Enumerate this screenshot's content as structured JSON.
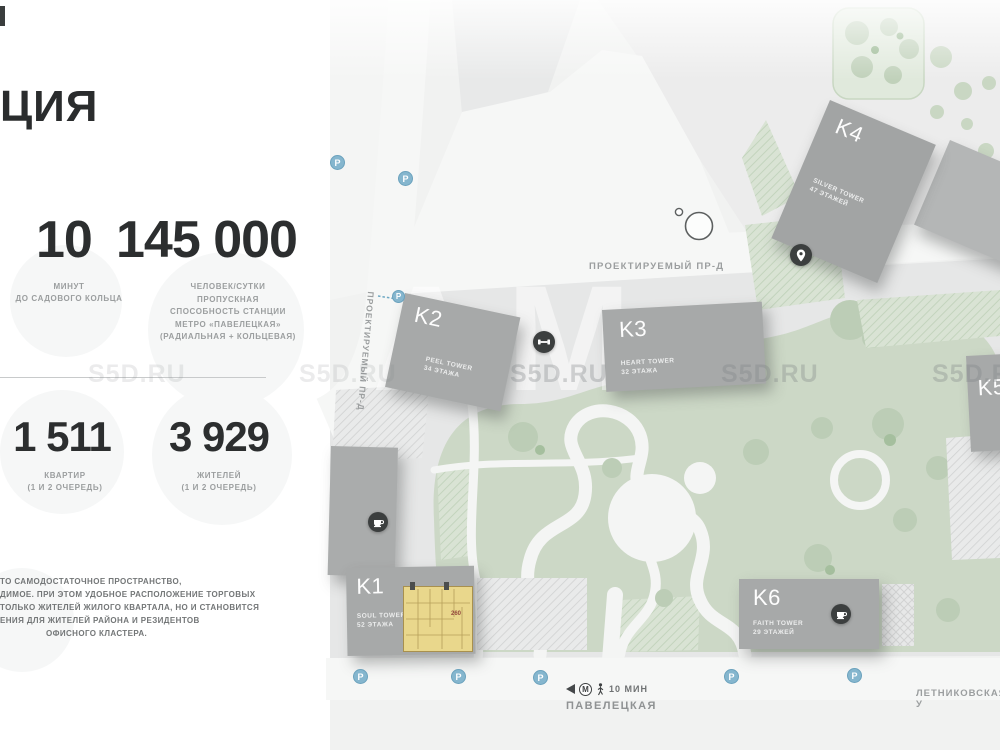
{
  "panel": {
    "clipped_title": "ЦИЯ",
    "stats_primary": {
      "minutes": {
        "value": "10",
        "lines": [
          "МИНУТ",
          "ДО САДОВОГО КОЛЬЦА"
        ]
      },
      "capacity": {
        "value": "145 000",
        "lines": [
          "ЧЕЛОВЕК/СУТКИ",
          "ПРОПУСКНАЯ",
          "СПОСОБНОСТЬ СТАНЦИИ",
          "МЕТРО «ПАВЕЛЕЦКАЯ»",
          "(РАДИАЛЬНАЯ + КОЛЬЦЕВАЯ)"
        ]
      }
    },
    "stats_secondary": {
      "apartments": {
        "value": "1 511",
        "lines": [
          "КВАРТИР",
          "(1 И 2 ОЧЕРЕДЬ)"
        ]
      },
      "residents": {
        "value": "3 929",
        "lines": [
          "ЖИТЕЛЕЙ",
          "(1 И 2 ОЧЕРЕДЬ)"
        ]
      }
    },
    "description_lines": [
      "ТО САМОДОСТАТОЧНОЕ ПРОСТРАНСТВО,",
      "ДИМОЕ. ПРИ ЭТОМ УДОБНОЕ РАСПОЛОЖЕНИЕ ТОРГОВЫХ",
      "ТОЛЬКО ЖИТЕЛЕЙ ЖИЛОГО КВАРТАЛА, НО И СТАНОВИТСЯ",
      "ЕНИЯ ДЛЯ ЖИТЕЛЕЙ РАЙОНА И РЕЗИДЕНТОВ",
      "ОФИСНОГО КЛАСТЕРА."
    ]
  },
  "map": {
    "buildings": {
      "k1": {
        "id": "K1",
        "name": "SOUL TOWER",
        "floors": "52 ЭТАЖА"
      },
      "k2": {
        "id": "K2",
        "name": "PEEL TOWER",
        "floors": "34 ЭТАЖА"
      },
      "k3": {
        "id": "K3",
        "name": "HEART TOWER",
        "floors": "32 ЭТАЖА"
      },
      "k4": {
        "id": "K4",
        "name": "SILVER TOWER",
        "floors": "47 ЭТАЖЕЙ"
      },
      "k5": {
        "id": "K5"
      },
      "k6": {
        "id": "K6",
        "name": "FAITH TOWER",
        "floors": "29 ЭТАЖЕЙ"
      }
    },
    "streets": {
      "projected_drive": "ПРОЕКТИРУЕМЫЙ ПР-Д",
      "letnikovskaya": "ЛЕТНИКОВСКАЯ У"
    },
    "metro": {
      "station": "ПАВЕЛЕЦКАЯ",
      "walk_time": "10 МИН",
      "letter": "М"
    },
    "parking_label": "P",
    "floorplan_note": "260",
    "watermark": "S5D.RU",
    "watermark_big": "АМ"
  },
  "colors": {
    "building_gray": "#a7a9a9",
    "park_green": "#ccd8c6",
    "parking_blue": "#85b6ce",
    "amenity_dark": "#3c3f3f",
    "plan_yellow": "#e9d78c"
  }
}
